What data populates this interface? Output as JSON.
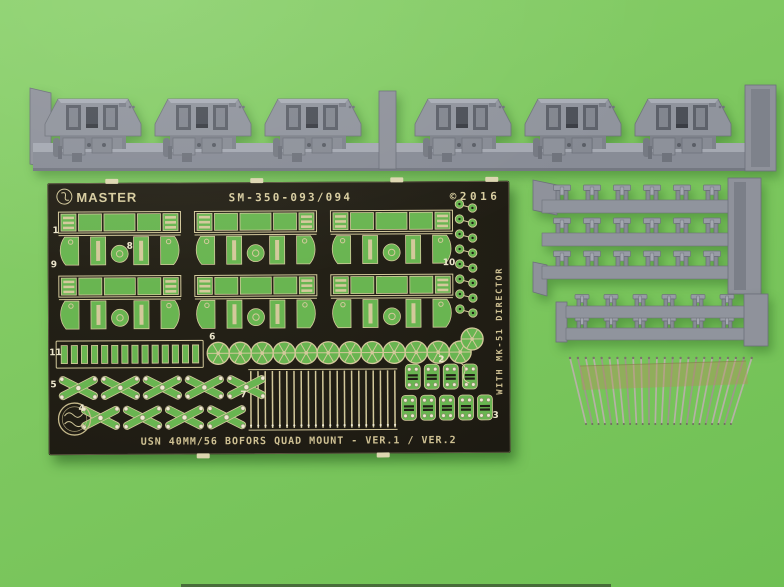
{
  "photo": {
    "background_color": "#7dc75f"
  },
  "fret": {
    "brand": "MASTER",
    "part_number": "SM-350-093/094",
    "copyright": "©2016",
    "title": "USN 40MM/56 BOFORS QUAD MOUNT - VER.1 / VER.2",
    "side_note": "WITH MK-51 DIRECTOR",
    "part_labels": {
      "p1": "1",
      "p2": "2",
      "p3": "3",
      "p4": "4",
      "p5": "5",
      "p6": "6",
      "p7": "7",
      "p8": "8",
      "p9": "9",
      "p10": "10",
      "p11": "11"
    },
    "colors": {
      "board": "#201d14",
      "metal_edge": "#d3c99b",
      "opening_green": "#69b551",
      "label": "#ece6cc"
    }
  },
  "parts_inventory": {
    "resin_gun_mounts": 6,
    "tray1_rows": 3,
    "tray1_parts_per_row": 6,
    "tray2_rows": 2,
    "tray2_parts_per_row": 6,
    "metal_barrels": 24,
    "fret_bracket_parts": 6,
    "mesh_discs": 12,
    "comb_slots": 14,
    "rail_strips": 21,
    "x_parts_top_row": 5,
    "x_parts_bottom_row": 4,
    "ladder_parts_top_row": 4,
    "ladder_parts_bottom_row": 5,
    "ring_pairs": 8
  },
  "icons": {
    "brand_logo": "master-logo-icon",
    "maker_stamp": "north-star-stamp-icon"
  }
}
